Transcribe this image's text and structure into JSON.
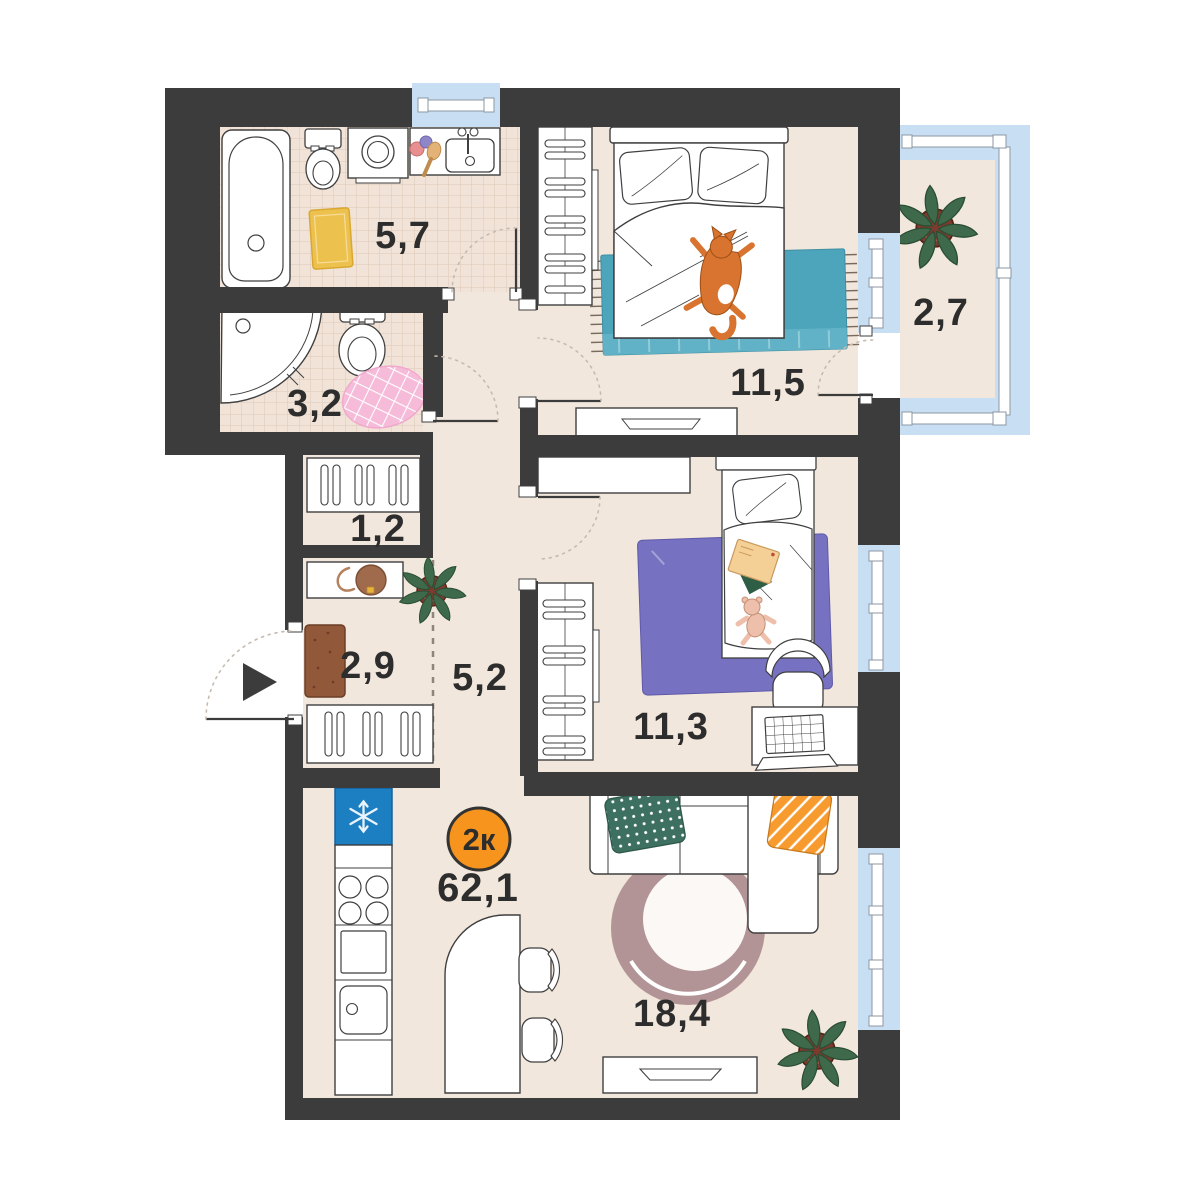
{
  "floorplan": {
    "badge": "2к",
    "total_area": "62,1",
    "rooms": {
      "bathroom": "5,7",
      "wc": "3,2",
      "storage": "1,2",
      "hallway": "2,9",
      "corridor": "5,2",
      "bedroom": "11,5",
      "balcony": "2,7",
      "kids_room": "11,3",
      "living_kitchen": "18,4"
    },
    "colors": {
      "wall": "#3c3c3c",
      "floor": "#f2e7dc",
      "tile_floor": "#f1e3d7",
      "window_glass": "#c8dff3",
      "badge_fill": "#f7941d",
      "fridge": "#1b7fc2",
      "rug_teal": "#4da5bb",
      "rug_purple": "#7672c1",
      "rug_round": "#b39496",
      "rug_yellow": "#ecc14e",
      "rug_pink": "#f6bbd9"
    }
  }
}
